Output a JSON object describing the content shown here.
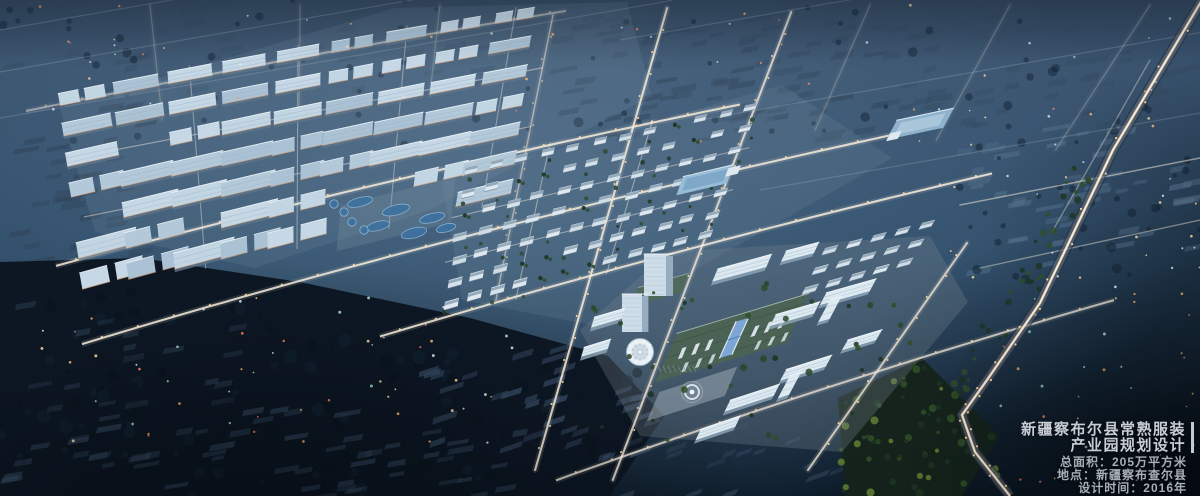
{
  "window": {
    "width": 1200,
    "height": 496
  },
  "scene": {
    "type": "architectural-aerial-render",
    "time_of_day": "dusk",
    "description": "Night-time aerial masterplan rendering: warehouse industrial district upper-left, wastewater treatment ponds, residential blocks in the centre, headquarters campus with green-roof factory hall, round exhibition hall and office slabs lower centre-right, surrounding dark existing town, forest and fields, lit road grid and a highway with light trails on the right."
  },
  "caption": {
    "title_line1": "新疆察布尔县常熟服装",
    "title_line2": "产业园规划设计",
    "stats": {
      "area": "总面积：205万平方米",
      "location": "地点：新疆察布查尔县",
      "date": "设计时间：2016年"
    }
  },
  "palette": {
    "text_title": "#c9ced6",
    "text_info": "#a8aeb6",
    "caption_bar": "#c2cad2",
    "haze_row": "#33485e",
    "haze_row_light": "#54708a",
    "forest": "#0b1520",
    "forest_mottle": "#10202e",
    "village_row": "#32455c",
    "park": "#15231a",
    "tree_dark": "#1c3320",
    "tree_mid": "#2f4d27",
    "tree_light": "#5d7a32",
    "road_glow": "#f2e5d6",
    "road_core": "#f7ecdc",
    "road_dim": "#c9d6e2",
    "street_light": "#ffd9a2",
    "facade_light": "#e09a62",
    "warehouse_a": "#b3c9da",
    "warehouse_b": "#c2d5e3",
    "warehouse_edge": "#eef5fa",
    "warehouse_shadow": "#5f7689",
    "residential": "#d6e2eb",
    "residential_roof": "#8ca2b2",
    "office": "#dde9f1",
    "office_shadow": "#8aa2b4",
    "office_stripe": "#b4c9d8",
    "tower_face": "#cfdde9",
    "tower_side": "#96adbf",
    "factory_roof": "#4b6354",
    "factory_stripe": "#3e5546",
    "skylight": "#7ca6d6",
    "skylight_frame": "#e9f1f8",
    "round_hall": "#eaf0f5",
    "round_hall_inner": "#c3d2de",
    "plaza": "#a3b0b9",
    "water": "#3f72a0",
    "water_rim": "#8ab4d2",
    "blue_roof": "#97bcd8",
    "dot_white": "#dfeaf2",
    "dot_green": "#9fe0c0",
    "dot_orange": "#ffb870",
    "dot_red": "#ff8860"
  }
}
